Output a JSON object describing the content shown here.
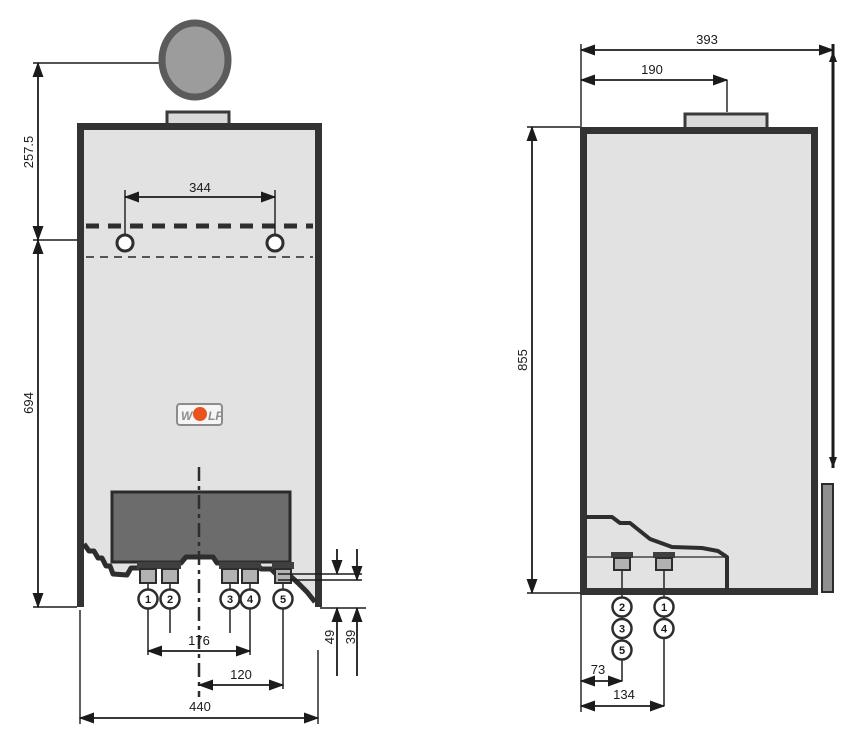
{
  "front_view": {
    "dimensions": {
      "flue_axis_to_mounting_holes": "257.5",
      "mounting_hole_spacing": "344",
      "mounting_holes_to_bottom": "694",
      "connection_1_to_4_spacing": "176",
      "center_to_connection_5": "120",
      "overall_width": "440",
      "connection_depth_a": "49",
      "connection_depth_b": "39"
    },
    "connections": [
      "1",
      "2",
      "3",
      "4",
      "5"
    ]
  },
  "side_view": {
    "dimensions": {
      "overall_depth": "393",
      "front_to_flue_center": "190",
      "overall_height": "855",
      "front_to_left_connection_column": "73",
      "front_to_right_connection_column": "134"
    },
    "left_column_connections": [
      "2",
      "3",
      "5"
    ],
    "right_column_connections": [
      "1",
      "4"
    ]
  },
  "logo": {
    "brand_left": "W",
    "brand_right": "LF"
  },
  "colors": {
    "logo_dot": "#e8541c",
    "case_fill": "#e2e2e2",
    "panel_fill": "#6c6c6c",
    "flue_fill": "#9c9c9c",
    "outline": "#2e2e2e"
  }
}
